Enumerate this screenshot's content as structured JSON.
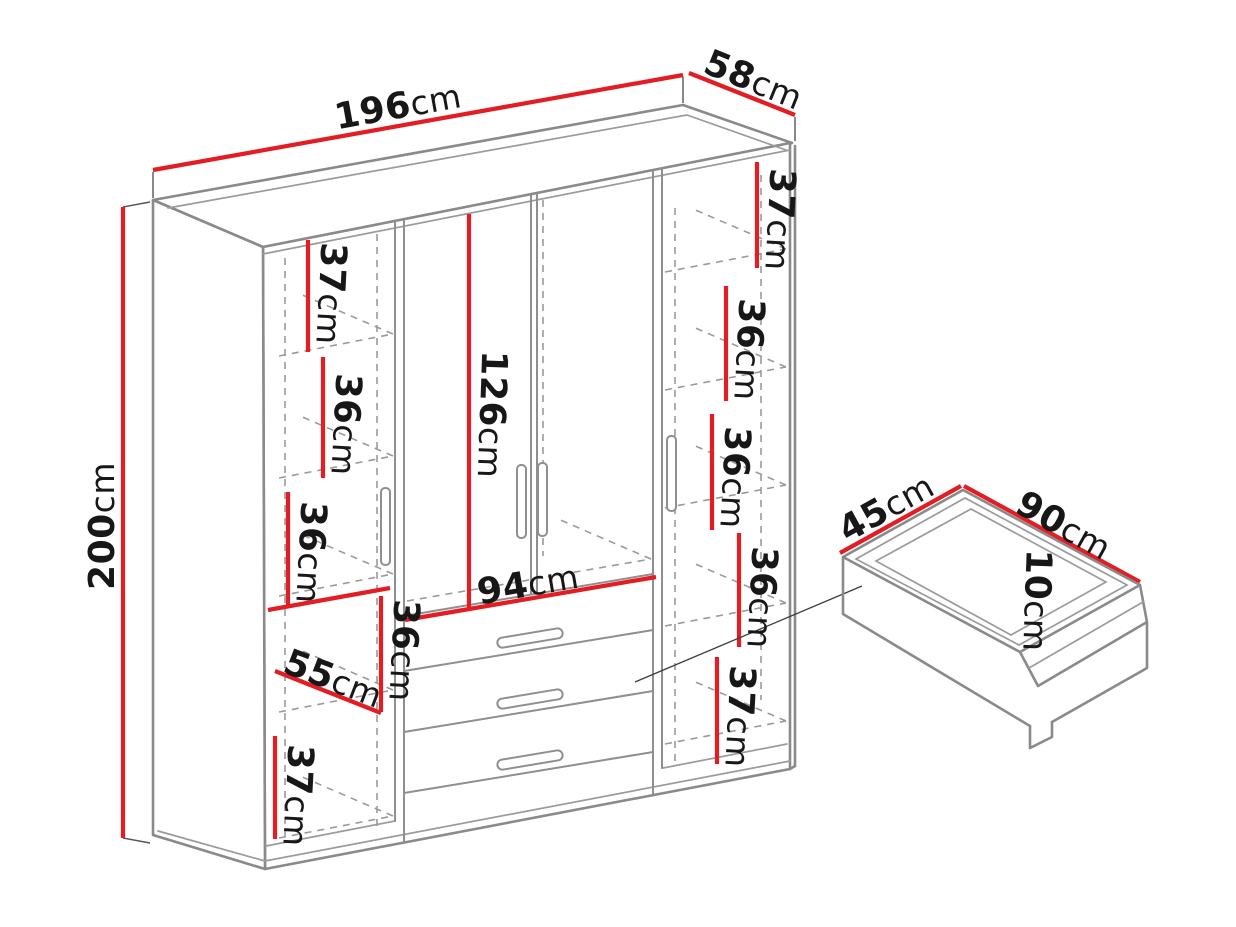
{
  "page": {
    "background": "#ffffff"
  },
  "colors": {
    "dimension_red": "#e21d24",
    "outline_gray": "#8a8a8a",
    "hidden_line_gray": "#9a9a9a",
    "text_black": "#171717"
  },
  "labels": {
    "width": {
      "v": "196",
      "u": "cm"
    },
    "depth": {
      "v": "58",
      "u": "cm"
    },
    "height": {
      "v": "200",
      "u": "cm"
    },
    "hanging_height": {
      "v": "126",
      "u": "cm"
    },
    "inner_width": {
      "v": "94",
      "u": "cm"
    },
    "shelf_depth": {
      "v": "55",
      "u": "cm"
    },
    "left_column": [
      {
        "v": "37",
        "u": "cm"
      },
      {
        "v": "36",
        "u": "cm"
      },
      {
        "v": "36",
        "u": "cm"
      },
      {
        "v": "36",
        "u": "cm"
      },
      {
        "v": "37",
        "u": "cm"
      }
    ],
    "right_column": [
      {
        "v": "37",
        "u": "cm"
      },
      {
        "v": "36",
        "u": "cm"
      },
      {
        "v": "36",
        "u": "cm"
      },
      {
        "v": "36",
        "u": "cm"
      },
      {
        "v": "37",
        "u": "cm"
      }
    ],
    "drawer": {
      "depth": {
        "v": "45",
        "u": "cm"
      },
      "width": {
        "v": "90",
        "u": "cm"
      },
      "height": {
        "v": "10",
        "u": "cm"
      }
    }
  }
}
